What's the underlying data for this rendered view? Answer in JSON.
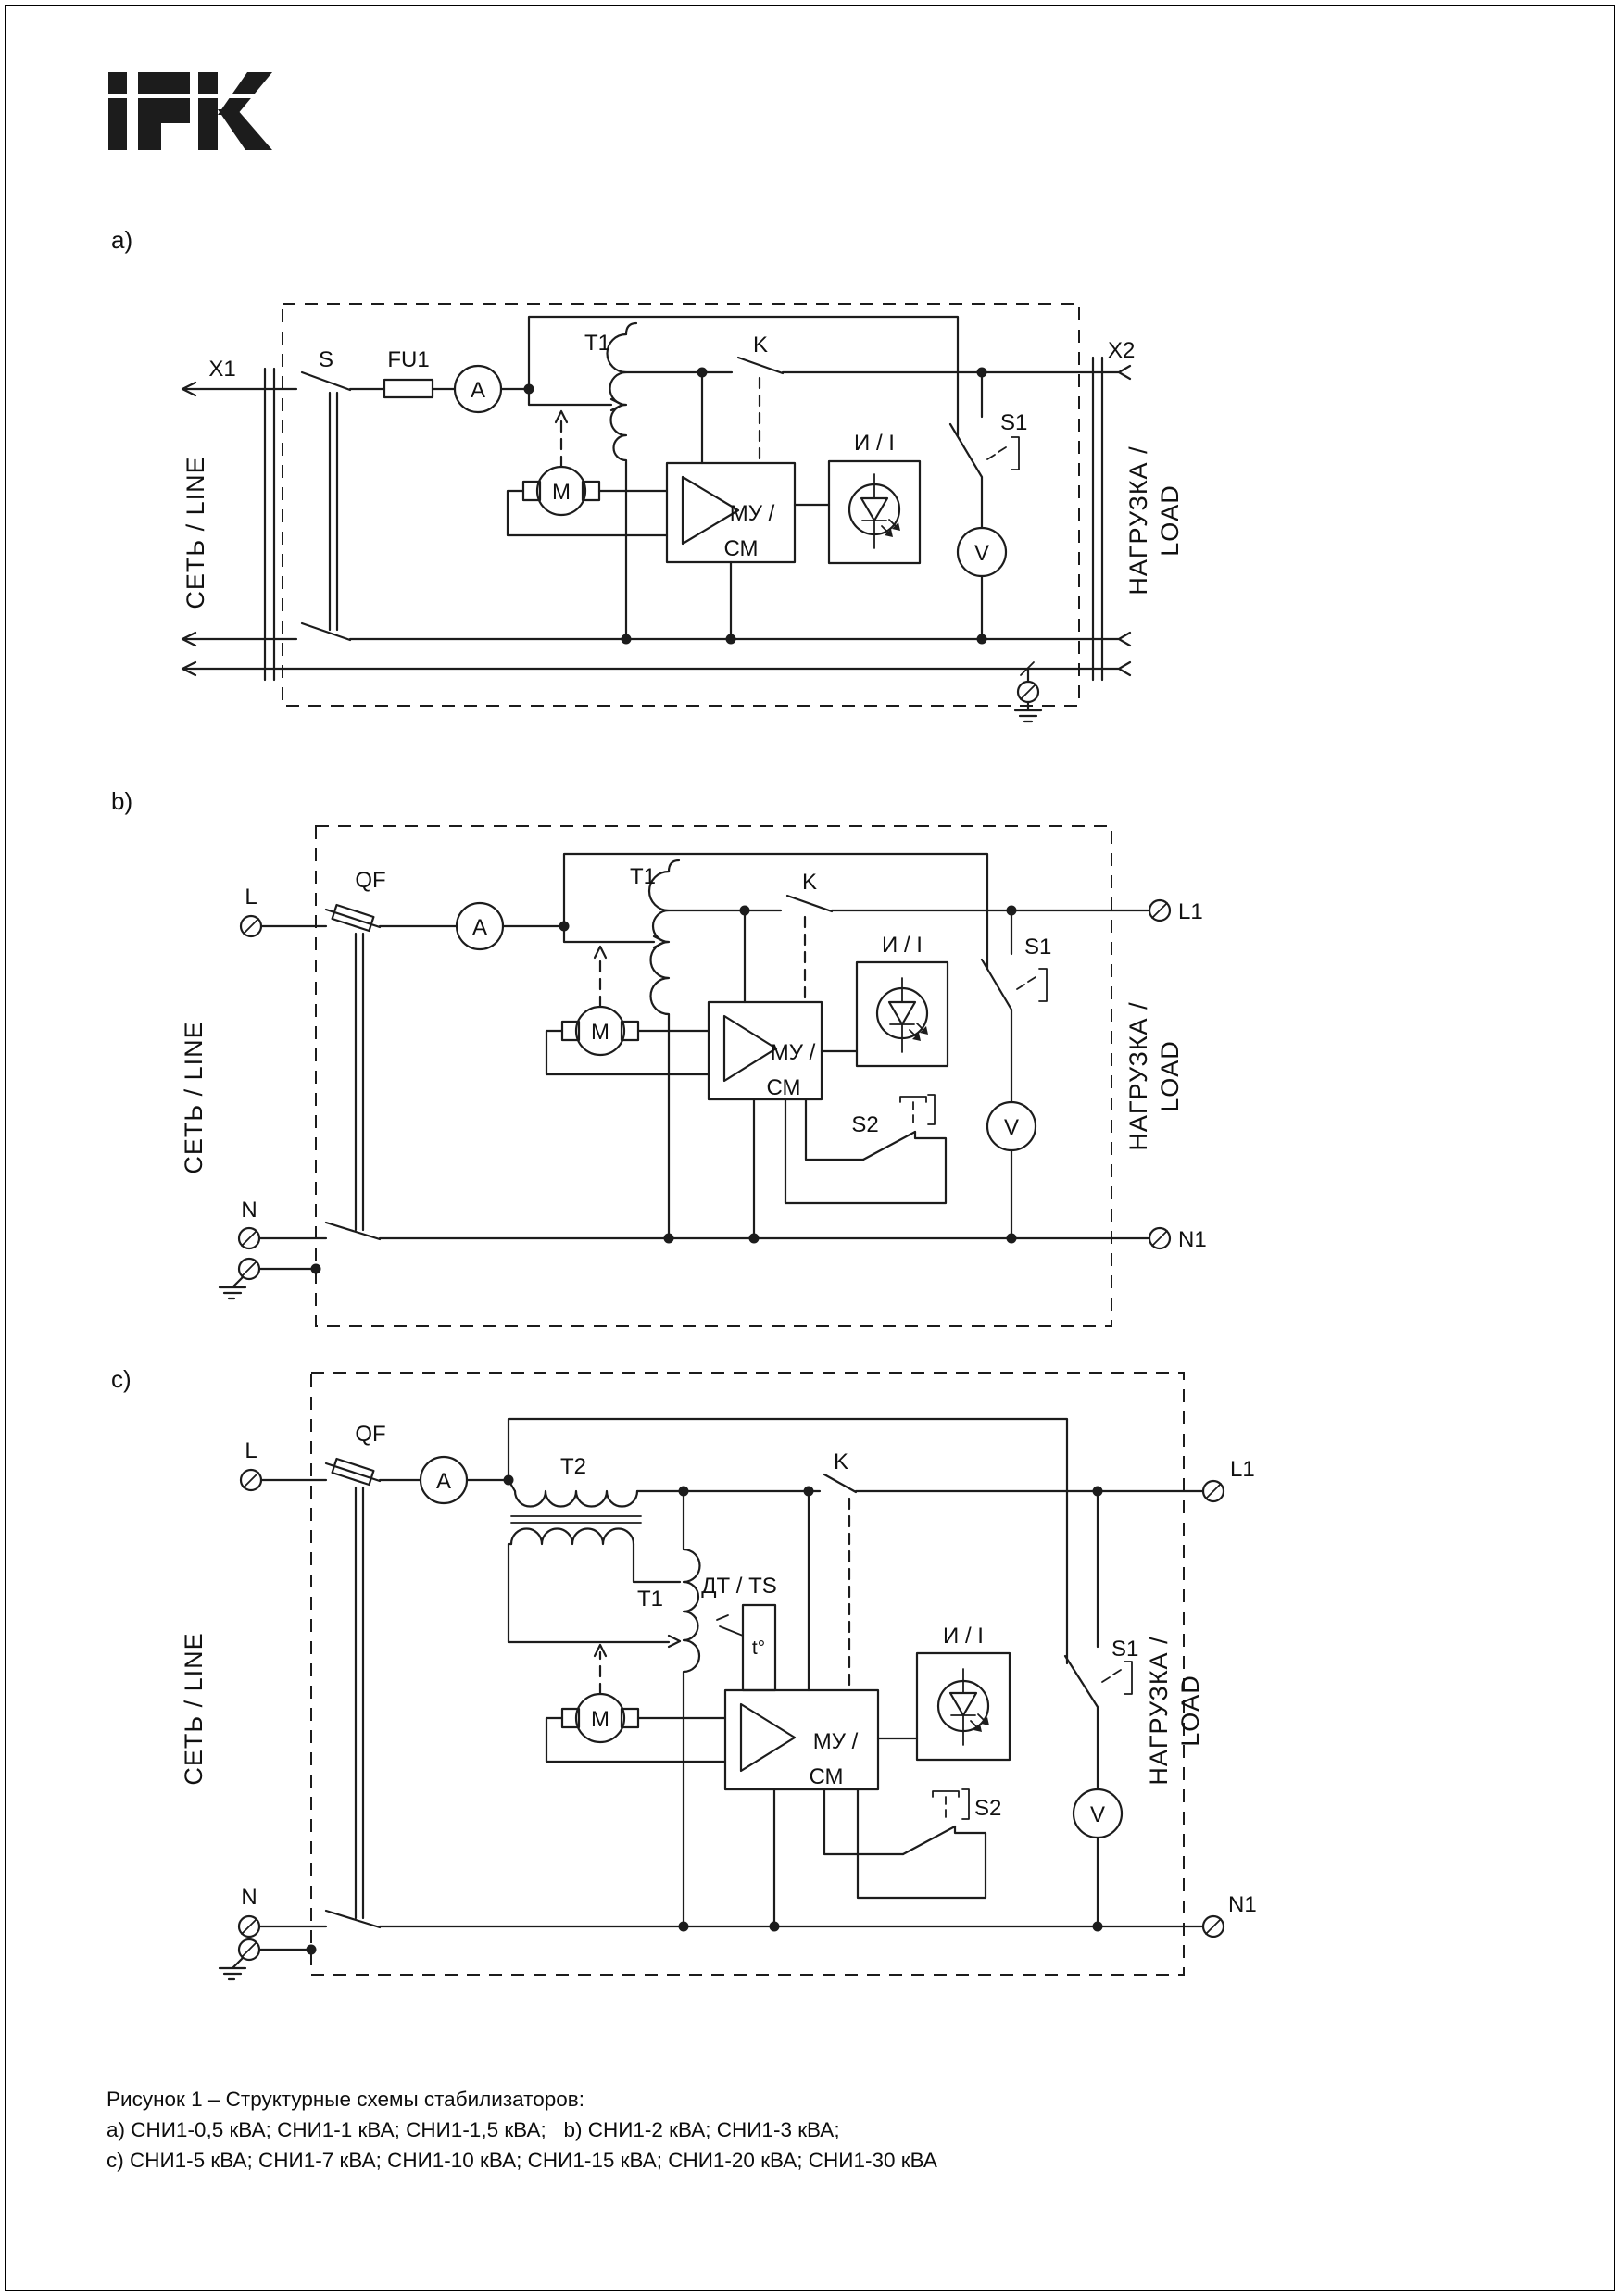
{
  "logo": {
    "brand": "IEK"
  },
  "a": {
    "label": "a)",
    "x1": "X1",
    "x2": "X2",
    "s": "S",
    "fu1": "FU1",
    "am": "A",
    "t1": "T1",
    "k": "K",
    "m": "M",
    "mu": "МУ /",
    "cm": "СМ",
    "ind": "И / I",
    "s1": "S1",
    "v": "V",
    "net": "СЕТЬ / LINE",
    "load1": "НАГРУЗКА /",
    "load2": "LOAD"
  },
  "b": {
    "label": "b)",
    "l": "L",
    "n": "N",
    "l1": "L1",
    "n1": "N1",
    "qf": "QF",
    "am": "A",
    "t1": "T1",
    "k": "K",
    "m": "M",
    "mu": "МУ /",
    "cm": "СМ",
    "ind": "И / I",
    "s1": "S1",
    "s2": "S2",
    "v": "V",
    "net": "СЕТЬ / LINE",
    "load1": "НАГРУЗКА /",
    "load2": "LOAD"
  },
  "c": {
    "label": "c)",
    "l": "L",
    "n": "N",
    "l1": "L1",
    "n1": "N1",
    "qf": "QF",
    "am": "A",
    "t1": "T1",
    "t2": "T2",
    "dt": "ДТ / TS",
    "tdeg": "t°",
    "k": "K",
    "m": "M",
    "mu": "МУ /",
    "cm": "СМ",
    "ind": "И / I",
    "s1": "S1",
    "s2": "S2",
    "v": "V",
    "net": "СЕТЬ / LINE",
    "load1": "НАГРУЗКА /",
    "load2": "LOAD"
  },
  "caption": {
    "line1": "Рисунок 1 – Структурные схемы стабилизаторов:",
    "line2": "a) СНИ1-0,5 кВА; СНИ1-1 кВА; СНИ1-1,5 кВА;   b) СНИ1-2 кВА; СНИ1-3 кВА;",
    "line3": "c) СНИ1-5 кВА; СНИ1-7 кВА; СНИ1-10 кВА; СНИ1-15 кВА; СНИ1-20 кВА; СНИ1-30 кВА"
  }
}
